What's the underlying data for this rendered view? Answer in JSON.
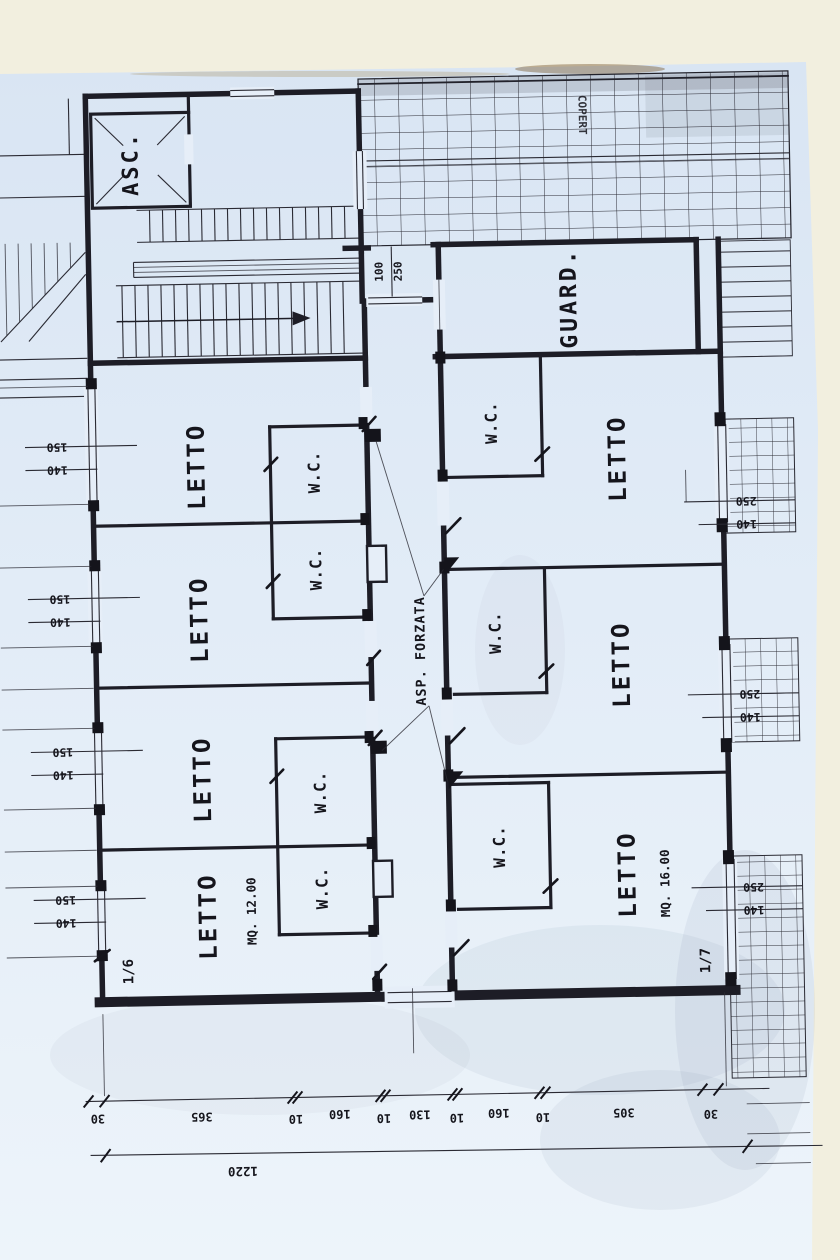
{
  "plan": {
    "elevator_label": "ASC.",
    "roof_note": "COPERT",
    "wardrobe_label": "GUARD.",
    "vent_label": "ASP. FORZATA",
    "left_rooms": [
      {
        "label": "LETTO",
        "wc": "W.C."
      },
      {
        "label": "LETTO",
        "wc": "W.C."
      },
      {
        "label": "LETTO",
        "wc": "W.C."
      },
      {
        "label": "LETTO",
        "wc": "W.C.",
        "area": "MQ. 12.00",
        "unit": "1/6"
      }
    ],
    "right_rooms": [
      {
        "label": "LETTO",
        "wc": "W.C."
      },
      {
        "label": "LETTO",
        "wc": "W.C."
      },
      {
        "label": "LETTO",
        "wc": "W.C.",
        "area": "MQ. 16.00",
        "unit": "1/7"
      }
    ]
  },
  "dimensions": {
    "corridor_door": {
      "width": "100",
      "height": "250"
    },
    "left_side": [
      {
        "top": "150",
        "bottom": "140"
      },
      {
        "top": "150",
        "bottom": "140"
      },
      {
        "top": "150",
        "bottom": "140"
      },
      {
        "top": "150",
        "bottom": "140"
      }
    ],
    "right_side": [
      {
        "top": "250",
        "bottom": "140"
      },
      {
        "top": "250",
        "bottom": "140"
      },
      {
        "top": "250",
        "bottom": "140"
      }
    ],
    "bottom_chain": [
      "30",
      "365",
      "10",
      "160",
      "10",
      "130",
      "10",
      "160",
      "10",
      "305",
      "30"
    ],
    "overall": "1220"
  },
  "colors": {
    "paper": "#dfe9f5",
    "ink": "#1d1d26",
    "scan_background": "#f2efdf"
  }
}
